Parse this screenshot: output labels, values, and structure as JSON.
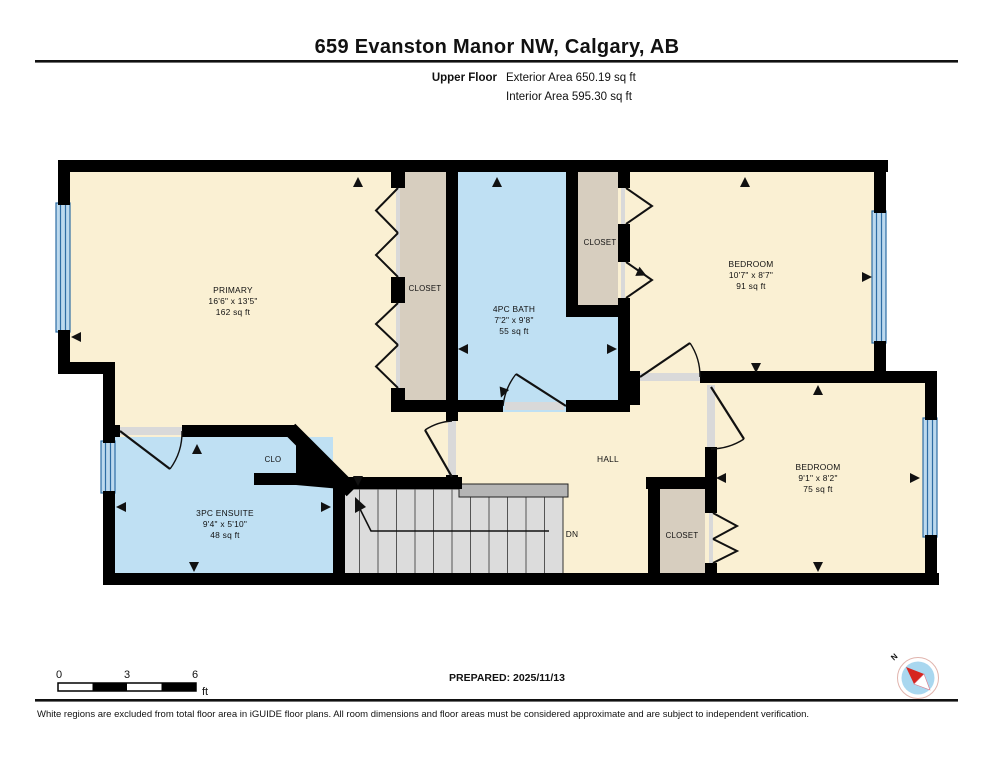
{
  "header": {
    "title": "659 Evanston Manor NW, Calgary, AB",
    "floor_label": "Upper Floor",
    "exterior_area": "Exterior Area 650.19 sq ft",
    "interior_area": "Interior Area 595.30 sq ft"
  },
  "rooms": {
    "primary": {
      "name": "PRIMARY",
      "dims": "16'6\" x 13'5\"",
      "area": "162 sq ft"
    },
    "bath": {
      "name": "4PC BATH",
      "dims": "7'2\" x 9'8\"",
      "area": "55 sq ft"
    },
    "bedroom1": {
      "name": "BEDROOM",
      "dims": "10'7\" x 8'7\"",
      "area": "91 sq ft"
    },
    "bedroom2": {
      "name": "BEDROOM",
      "dims": "9'1\" x 8'2\"",
      "area": "75 sq ft"
    },
    "ensuite": {
      "name": "3PC ENSUITE",
      "dims": "9'4\" x 5'10\"",
      "area": "48 sq ft"
    },
    "closet_primary": "CLOSET",
    "closet_top": "CLOSET",
    "closet_bottom": "CLOSET",
    "clo": "CLO",
    "hall": "HALL",
    "dn": "DN"
  },
  "scale_bar": {
    "tick0": "0",
    "tick3": "3",
    "tick6": "6",
    "unit": "ft"
  },
  "footer": {
    "prepared": "PREPARED: 2025/11/13",
    "compass_n": "N",
    "disclaimer": "White regions are excluded from total floor area in iGUIDE floor plans. All room dimensions and floor areas must be considered approximate and are subject to independent verification."
  },
  "colors": {
    "room_fill": "#faf0d3",
    "closet_fill": "#d7cebf",
    "wet_fill": "#bfe0f3",
    "stairs_fill": "#dcdcdc",
    "window_fill": "#bcd9ee",
    "wall": "#000000",
    "compass_blue": "#a9d7ef",
    "compass_red": "#d6251f"
  }
}
